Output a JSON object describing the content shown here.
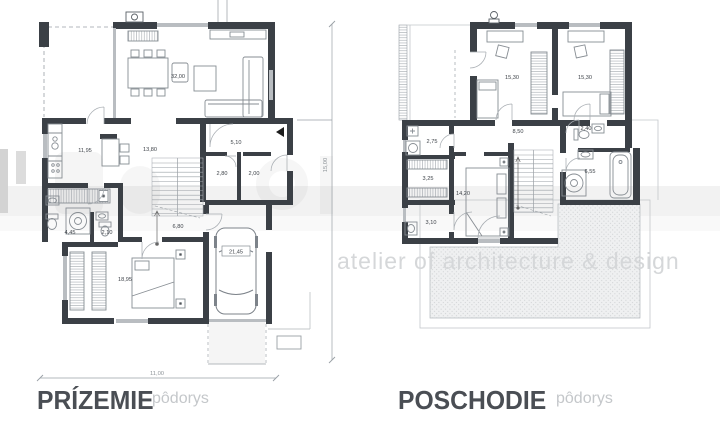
{
  "colors": {
    "wall": "#3b4046",
    "window": "#b9bdc1",
    "furniture_line": "#878d93",
    "label_text": "#3f444a",
    "title_text": "#4a4e54",
    "subtitle_text": "#c4c7ca",
    "watermark_text": "#d5d7d9"
  },
  "ground_floor": {
    "title": "PRÍZEMIE",
    "subtitle": "pôdorys",
    "dim_width": "11,00",
    "dim_height": "15,00",
    "rooms": {
      "living": "32,00",
      "kitchen": "11,95",
      "hall": "13,80",
      "entry": "5,10",
      "pantry": "2,80",
      "wc": "2,00",
      "bath": "4,45",
      "wc2": "2,10",
      "stairs": "6,80",
      "bedroom": "18,95",
      "garage": "21,45"
    }
  },
  "upper_floor": {
    "title": "POSCHODIE",
    "subtitle": "pôdorys",
    "rooms": {
      "bedroom_left": "15,30",
      "bedroom_right": "15,30",
      "hall": "8,50",
      "laundry": "2,75",
      "closet": "3,25",
      "bedroom_master": "14,20",
      "storage": "3,10",
      "wc": "2,40",
      "bath": "6,55"
    }
  },
  "watermark": {
    "tagline": "atelier of architecture & design"
  }
}
